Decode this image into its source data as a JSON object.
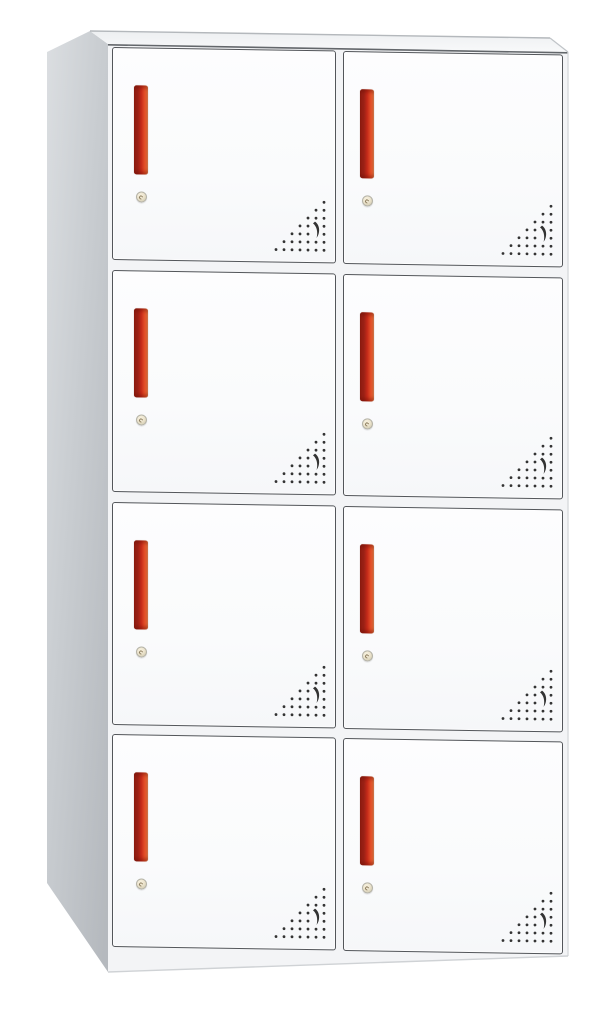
{
  "scene": {
    "type": "product-photo",
    "subject": "Eight-door white metal office locker cabinet with vertical red recessed handles, round keyhole locks and corner ventilation perforations, shown in three-quarter view on a plain white background",
    "background_color": "#ffffff",
    "visible_text": ""
  },
  "cabinet": {
    "door_rows": 4,
    "door_columns": 2,
    "door_count": 8,
    "features_per_door": [
      "recessed-red-handle",
      "round-keyhole-lock",
      "corner-vent-perforation"
    ],
    "colors": {
      "door_face": "#fbfcfd",
      "door_border": "#53565a",
      "frame_face": "#f3f4f6",
      "top_panel_back": "#edeff1",
      "top_panel_front": "#f8f9fa",
      "side_panel_light": "#d9dcdf",
      "side_panel_dark": "#b7bbc0",
      "handle_dark": "#9a2115",
      "handle_main": "#c52a19",
      "handle_bright": "#e8552a",
      "handle_edge": "#f0854f",
      "lock_face": "#ede5cf",
      "lock_ring": "#b5b3a8",
      "lock_keyhole": "#8f8061",
      "vent_dot": "#333333"
    },
    "vent_pattern": {
      "shape": "right-triangle dot grid with crescent cut-out",
      "row_dot_counts_bottom_to_top": [
        7,
        6,
        5,
        4,
        3,
        2,
        1
      ],
      "skip_cells_row_col": [
        [
          2,
          1
        ],
        [
          3,
          1
        ]
      ],
      "dot_spacing_px": 8
    }
  }
}
